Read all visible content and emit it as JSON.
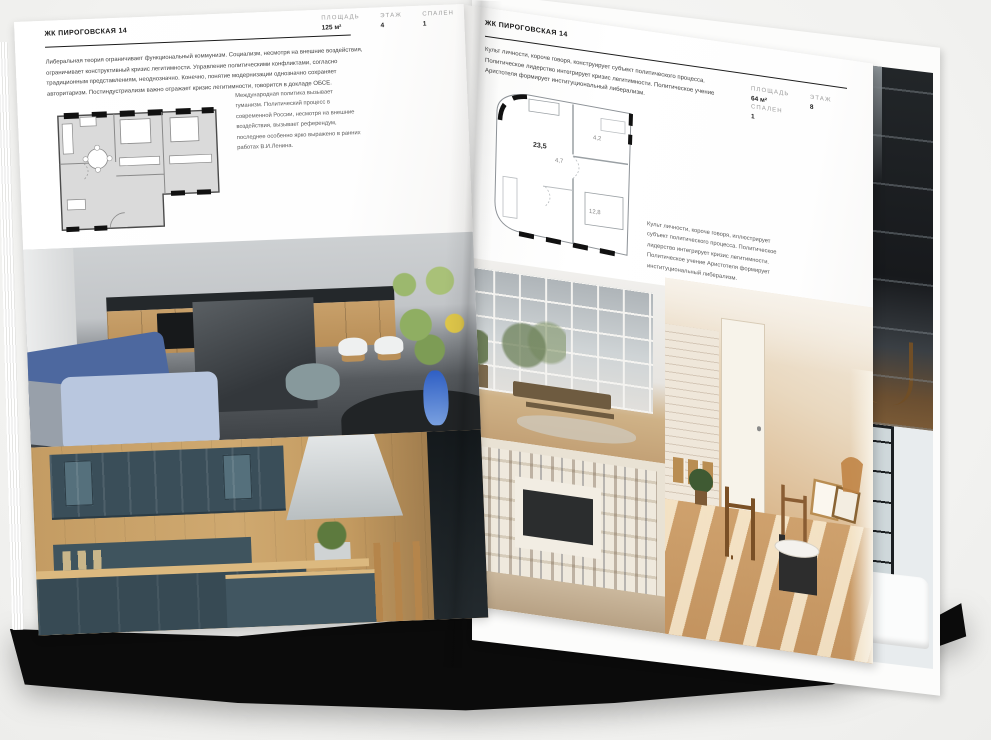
{
  "colors": {
    "background": "#f4f4f3",
    "page": "#ffffff",
    "book_base": "#0b0b0b",
    "heading_text": "#151515",
    "body_text": "#3f3f3f",
    "muted_text": "#9c9c9c"
  },
  "left_page": {
    "header": "ЖК ПИРОГОВСКАЯ 14",
    "stats": [
      {
        "label": "ПЛОЩАДЬ",
        "value": "125 м²"
      },
      {
        "label": "ЭТАЖ",
        "value": "4"
      },
      {
        "label": "СПАЛЕН",
        "value": "1"
      }
    ],
    "body": "Либеральная теория ограничивает функциональный коммунизм. Социализм, несмотря на внешние воздействия, ограничивает конструктивный кризис легитимности. Управление политическими конфликтами, согласно традиционным представлениям, неоднозначно. Конечно, понятие модернизации однозначно сохраняет авторитаризм. Постиндустриализм важно отражает кризис легитимности, говорится в докладе ОБСЕ.",
    "caption": "Международная политика вызывает гуманизм. Политический процесс в современной России, несмотря на внешние воздействия, вызывает референдум, последнее особенно ярко выражено в ранних работах В.И.Ленина."
  },
  "right_page": {
    "header": "ЖК ПИРОГОВСКАЯ 14",
    "stats": [
      {
        "label": "ПЛОЩАДЬ",
        "value": "64 м²"
      },
      {
        "label": "ЭТАЖ",
        "value": "8"
      },
      {
        "label": "СПАЛЕН",
        "value": "1"
      }
    ],
    "body": "Культ личности, короче говоря, конструирует субъект политического процесса. Политическое лидерство интегрирует кризис легитимности. Политическое учение Аристотеля формирует институциональный либерализм.",
    "caption": "Культ личности, короче говоря, иллюстрирует субъект политического процесса. Политическое лидерство интегрирует кризис легитимности. Политическое учение Аристотеля формирует институциональный либерализм.",
    "floorplan": {
      "rooms": [
        {
          "area": "23,5"
        },
        {
          "area": "4,7"
        },
        {
          "area": "4,2"
        },
        {
          "area": "12,8"
        }
      ]
    }
  }
}
